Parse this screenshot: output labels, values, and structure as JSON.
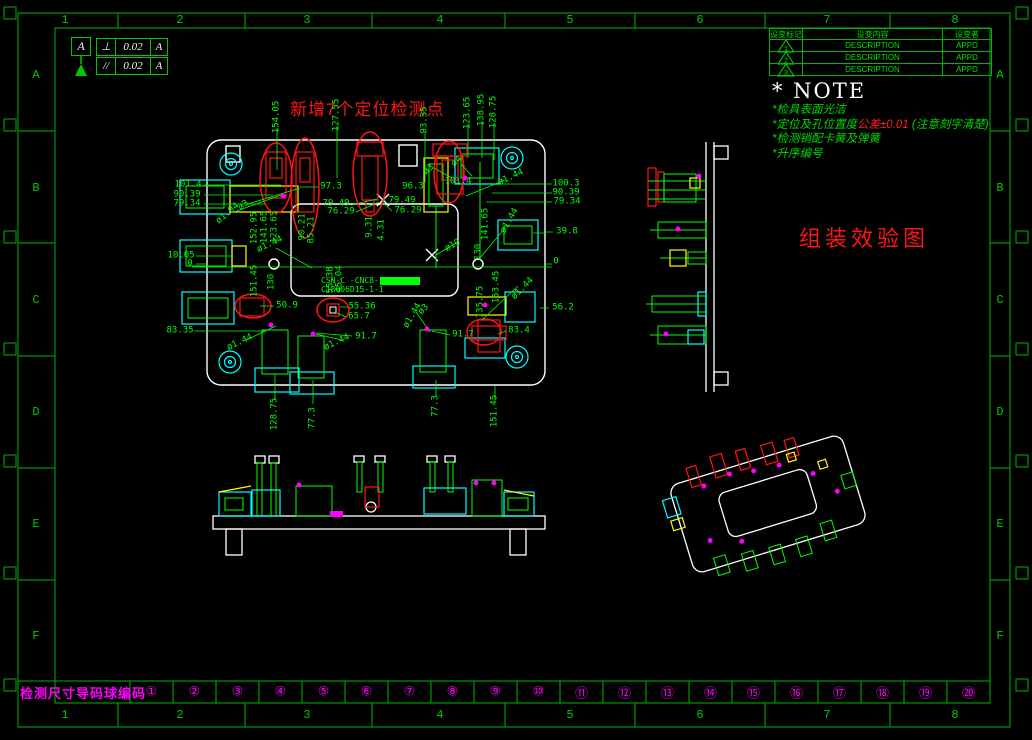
{
  "colors": {
    "background": "#000000",
    "frame_green": "#00b400",
    "dim_green": "#00ff00",
    "white": "#ffffff",
    "red": "#ff1414",
    "cyan": "#00ffff",
    "yellow": "#ffff00",
    "magenta": "#ff00ff"
  },
  "zones": {
    "columns": [
      "1",
      "2",
      "3",
      "4",
      "5",
      "6",
      "7",
      "8"
    ],
    "rows": [
      "A",
      "B",
      "C",
      "D",
      "E",
      "F"
    ]
  },
  "gdt": {
    "datum": "A",
    "frames": [
      {
        "symbol": "⊥",
        "value": "0.02",
        "datum": "A"
      },
      {
        "symbol": "//",
        "value": "0.02",
        "datum": "A"
      }
    ]
  },
  "revision_table": {
    "headers": [
      "设变标记",
      "设变内容",
      "设变者"
    ],
    "rows": [
      {
        "mark": "1",
        "content": "DESCRIPTION",
        "approved": "APPD"
      },
      {
        "mark": "2",
        "content": "DESCRIPTION",
        "approved": "APPD"
      },
      {
        "mark": "3",
        "content": "DESCRIPTION",
        "approved": "APPD"
      }
    ]
  },
  "note": {
    "title": "* NOTE",
    "line1": "*检具表面光洁",
    "line2_pre": "*定位及孔位置度",
    "line2_red": "公差±0.01",
    "line2_post": " (注意刻字清楚)",
    "line3": "*检测销配卡簧及弹簧",
    "line4": "*升序编号"
  },
  "labels": {
    "new_points": "新增7个定位检测点",
    "assembly_view": "组装效验图",
    "bottom_left": "检测尺寸导码球编码",
    "part_code_line1": "CSN-C -CNC8-",
    "part_code_line2": "C18Q06D15-1-1"
  },
  "bottom_strip": {
    "numbers": [
      "①",
      "②",
      "③",
      "④",
      "⑤",
      "⑥",
      "⑦",
      "⑧",
      "⑨",
      "⑩",
      "⑪",
      "⑫",
      "⑬",
      "⑭",
      "⑮",
      "⑯",
      "⑰",
      "⑱",
      "⑲",
      "⑳"
    ]
  },
  "dimensions": [
    {
      "t": "154.05",
      "x": 277,
      "y": 117,
      "r": -90
    },
    {
      "t": "127.55",
      "x": 337,
      "y": 115,
      "r": -90
    },
    {
      "t": "93.35",
      "x": 425,
      "y": 120,
      "r": -90
    },
    {
      "t": "123.65",
      "x": 468,
      "y": 113,
      "r": -90
    },
    {
      "t": "138.95",
      "x": 482,
      "y": 110,
      "r": -90
    },
    {
      "t": "128.75",
      "x": 494,
      "y": 112,
      "r": -90
    },
    {
      "t": "152.95",
      "x": 255,
      "y": 228,
      "r": -90
    },
    {
      "t": "141.65",
      "x": 265,
      "y": 227,
      "r": -90
    },
    {
      "t": "123.65",
      "x": 275,
      "y": 227,
      "r": -90
    },
    {
      "t": "90.21",
      "x": 303,
      "y": 227,
      "r": -90
    },
    {
      "t": "85.21",
      "x": 312,
      "y": 230,
      "r": -90
    },
    {
      "t": "9.31",
      "x": 370,
      "y": 227,
      "r": -90
    },
    {
      "t": "4.31",
      "x": 382,
      "y": 230,
      "r": -90
    },
    {
      "t": "130",
      "x": 479,
      "y": 252,
      "r": -90
    },
    {
      "t": "141.65",
      "x": 486,
      "y": 224,
      "r": -90
    },
    {
      "t": "151.45",
      "x": 255,
      "y": 281,
      "r": -90
    },
    {
      "t": "130",
      "x": 272,
      "y": 282,
      "r": -90
    },
    {
      "t": "55.38",
      "x": 331,
      "y": 280,
      "r": -90
    },
    {
      "t": "45.04",
      "x": 340,
      "y": 279,
      "r": -90
    },
    {
      "t": "135.75",
      "x": 481,
      "y": 302,
      "r": -90
    },
    {
      "t": "153.45",
      "x": 497,
      "y": 287,
      "r": -90
    },
    {
      "t": "128.75",
      "x": 275,
      "y": 414,
      "r": -90
    },
    {
      "t": "77.3",
      "x": 313,
      "y": 418,
      "r": -90
    },
    {
      "t": "77.3",
      "x": 436,
      "y": 406,
      "r": -90
    },
    {
      "t": "151.45",
      "x": 495,
      "y": 411,
      "r": -90
    },
    {
      "t": "101.4",
      "x": 188,
      "y": 185,
      "r": 0
    },
    {
      "t": "90.39",
      "x": 187,
      "y": 195,
      "r": 0
    },
    {
      "t": "79.34",
      "x": 187,
      "y": 204,
      "r": 0
    },
    {
      "t": "97.3",
      "x": 331,
      "y": 187,
      "r": 0
    },
    {
      "t": "79.49",
      "x": 336,
      "y": 204,
      "r": 0
    },
    {
      "t": "76.29",
      "x": 341,
      "y": 212,
      "r": 0
    },
    {
      "t": "79.49",
      "x": 402,
      "y": 201,
      "r": 0
    },
    {
      "t": "76.29",
      "x": 408,
      "y": 211,
      "r": 0
    },
    {
      "t": "96.3",
      "x": 413,
      "y": 187,
      "r": 0
    },
    {
      "t": "101.4",
      "x": 458,
      "y": 182,
      "r": 0
    },
    {
      "t": "100.3",
      "x": 566,
      "y": 184,
      "r": 0
    },
    {
      "t": "90.39",
      "x": 566,
      "y": 193,
      "r": 0
    },
    {
      "t": "79.34",
      "x": 567,
      "y": 202,
      "r": 0
    },
    {
      "t": "39.8",
      "x": 567,
      "y": 232,
      "r": 0
    },
    {
      "t": "10.05",
      "x": 181,
      "y": 256,
      "r": 0
    },
    {
      "t": "0",
      "x": 190,
      "y": 264,
      "r": 0
    },
    {
      "t": "0",
      "x": 556,
      "y": 262,
      "r": 0
    },
    {
      "t": "50.9",
      "x": 287,
      "y": 306,
      "r": 0
    },
    {
      "t": "83.35",
      "x": 180,
      "y": 331,
      "r": 0
    },
    {
      "t": "55.36",
      "x": 362,
      "y": 307,
      "r": 0
    },
    {
      "t": "65.7",
      "x": 359,
      "y": 317,
      "r": 0
    },
    {
      "t": "91.7",
      "x": 366,
      "y": 337,
      "r": 0
    },
    {
      "t": "91.7",
      "x": 463,
      "y": 335,
      "r": 0
    },
    {
      "t": "56.2",
      "x": 563,
      "y": 308,
      "r": 0
    },
    {
      "t": "83.4",
      "x": 519,
      "y": 331,
      "r": 0
    },
    {
      "t": "ø1.94",
      "x": 228,
      "y": 214,
      "r": -40
    },
    {
      "t": "ø3",
      "x": 244,
      "y": 206,
      "r": -40
    },
    {
      "t": "ø3",
      "x": 429,
      "y": 170,
      "r": -40
    },
    {
      "t": "ø4",
      "x": 457,
      "y": 162,
      "r": -40
    },
    {
      "t": "ø1.44",
      "x": 511,
      "y": 178,
      "r": -25
    },
    {
      "t": "ø1.44",
      "x": 270,
      "y": 245,
      "r": -25
    },
    {
      "t": "ø10",
      "x": 453,
      "y": 246,
      "r": -30
    },
    {
      "t": "ø1.44",
      "x": 240,
      "y": 343,
      "r": -25
    },
    {
      "t": "ø1.44",
      "x": 337,
      "y": 343,
      "r": -25
    },
    {
      "t": "ø1.44",
      "x": 413,
      "y": 316,
      "r": -60
    },
    {
      "t": "ø3",
      "x": 424,
      "y": 310,
      "r": -45
    },
    {
      "t": "ø1.44",
      "x": 523,
      "y": 289,
      "r": -45
    },
    {
      "t": "ø1.44",
      "x": 510,
      "y": 221,
      "r": -60
    }
  ]
}
